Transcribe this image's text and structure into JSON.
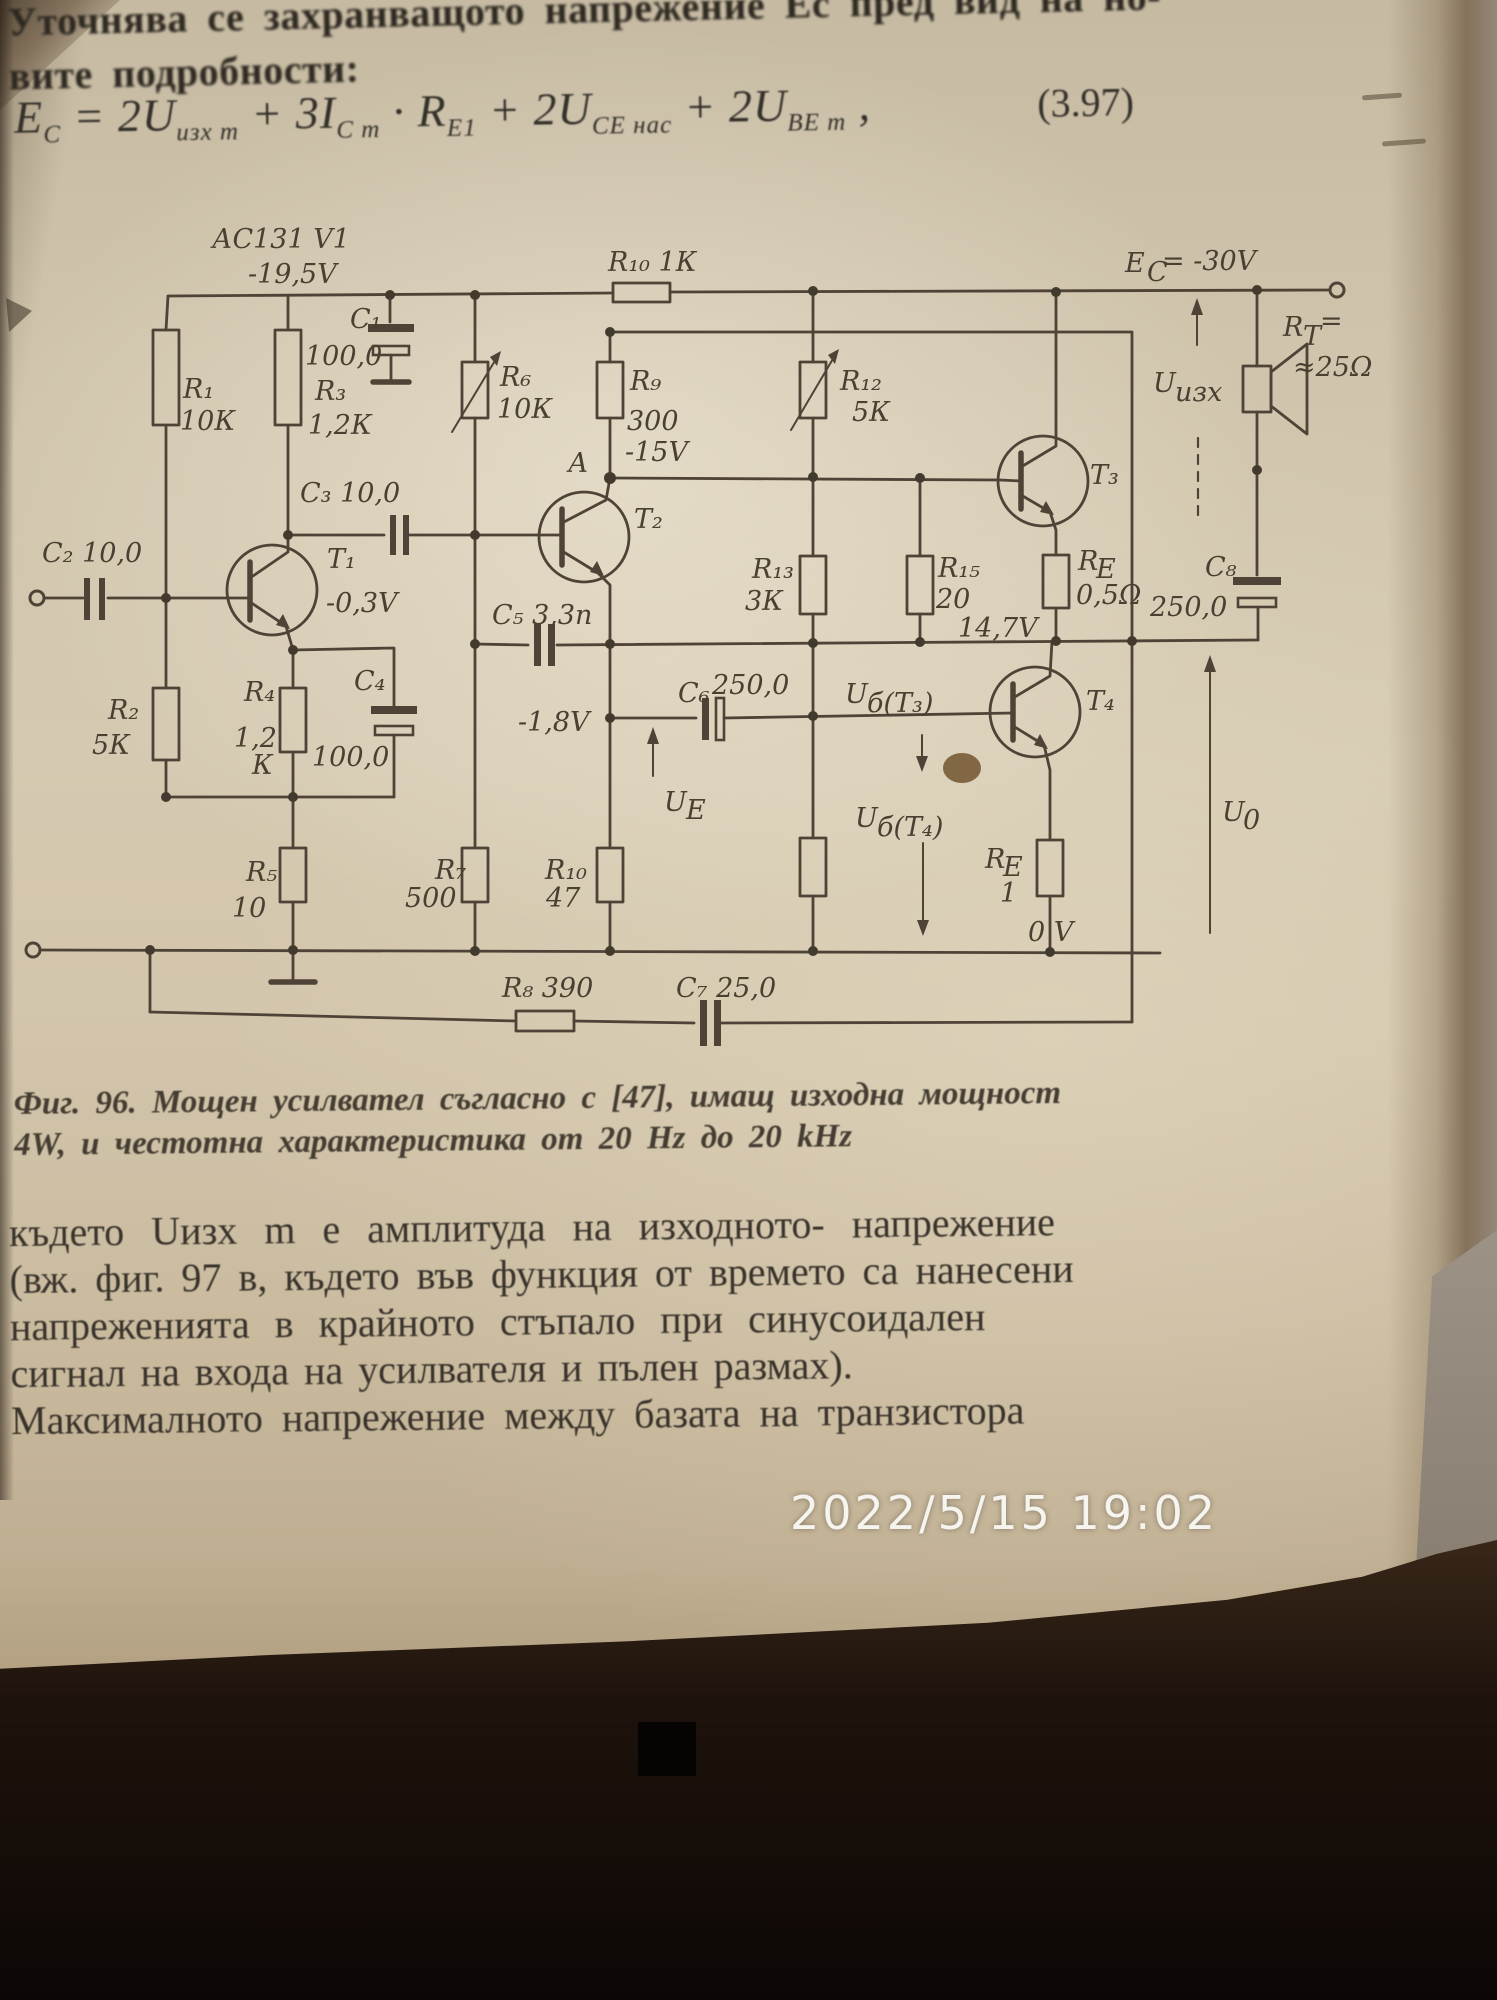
{
  "photo": {
    "timestamp": "2022/5/15 19:02"
  },
  "page": {
    "intro_line_1": "Уточнява се захранващото напрежение Ес пред вид на но-",
    "intro_line_2": "вите подробности:",
    "equation_number": "(3.97)",
    "formula_segments": [
      {
        "t": "E"
      },
      {
        "t": "C",
        "sub": true
      },
      {
        "t": " = 2U"
      },
      {
        "t": "изх m",
        "sub": true
      },
      {
        "t": " + 3I"
      },
      {
        "t": "C m",
        "sub": true
      },
      {
        "t": " · R"
      },
      {
        "t": "Е1",
        "sub": true
      },
      {
        "t": " + 2U"
      },
      {
        "t": "CE нас",
        "sub": true
      },
      {
        "t": " + 2U"
      },
      {
        "t": "BE m",
        "sub": true
      },
      {
        "t": " ,"
      }
    ],
    "caption_line_1": "Фиг. 96. Мощен усилвател съгласно с [47], имащ изходна мощност",
    "caption_line_2": "4W, и честотна характеристика от 20 Hz до 20 kHz",
    "body_lines": [
      "където Uизх m е амплитуда на изходното- напрежение",
      "(вж. фиг. 97 в, където във функция от времето са нанесени",
      "напреженията в крайното стъпало при синусоидален",
      "сигнал на входа на усилвателя и пълен размах).",
      "Максималното напрежение между базата на транзистора"
    ]
  },
  "schematic": {
    "labels": {
      "transistor_type": "АС131 V1",
      "supply_t1": "-19,5V",
      "c1": "C₁",
      "c1_val": "100,0",
      "r1": "R₁",
      "r1_val": "10К",
      "r3": "R₃",
      "r3_val": "1,2К",
      "c2": "C₂ 10,0",
      "r2": "R₂",
      "r2_val": "5К",
      "t1": "Т₁",
      "t1_bias": "-0,3V",
      "c3": "C₃ 10,0",
      "r4": "R₄",
      "r4_val": "1,2",
      "r4_unit": "К",
      "c4": "C₄",
      "c4_val": "100,0",
      "r5": "R₅",
      "r5_val": "10",
      "r6": "R₆",
      "r6_val": "10К",
      "r10_top": "R₁₀ 1К",
      "r9": "R₉",
      "r9_val": "300",
      "r9_bias": "-15V",
      "node_a": "А",
      "t2": "Т₂",
      "c5": "C₅ 3,3n",
      "bias_18": "-1,8V",
      "r7": "R₇",
      "r7_val": "500",
      "r10_bot": "R₁₀",
      "r10_bot_val": "47",
      "r8": "R₈ 390",
      "c7": "C₇ 25,0",
      "r12": "R₁₂",
      "r12_val": "5К",
      "r13": "R₁₃",
      "r13_val": "3К",
      "r15": "R₁₅",
      "r15_val": "20",
      "bias_147": "14,7V",
      "re_top": "R",
      "re_top_sub": "Е",
      "re_top_val": "0,5Ω",
      "c6": "C₆",
      "c6_val": "250,0",
      "ub3_base": "U",
      "ub3_sub": "б(Т₃)",
      "ue_base": "U",
      "ue_sub": "Е",
      "ub4_base": "U",
      "ub4_sub": "б(Т₄)",
      "t3": "Т₃",
      "t4": "Т₄",
      "re_bot": "R",
      "re_bot_sub": "Е",
      "re_bot_val": "1",
      "ec_base": "Е",
      "ec_sub": "С",
      "ec_val": "= -30V",
      "uout_base": "U",
      "uout_sub": "изх",
      "rt_base": "R",
      "rt_sub": "Т",
      "rt_eq": "=",
      "rt_val": "≈25Ω",
      "c8": "C₈",
      "c8_val": "250,0",
      "u0_base": "U",
      "u0_sub": "0",
      "gnd": "0 V"
    }
  }
}
